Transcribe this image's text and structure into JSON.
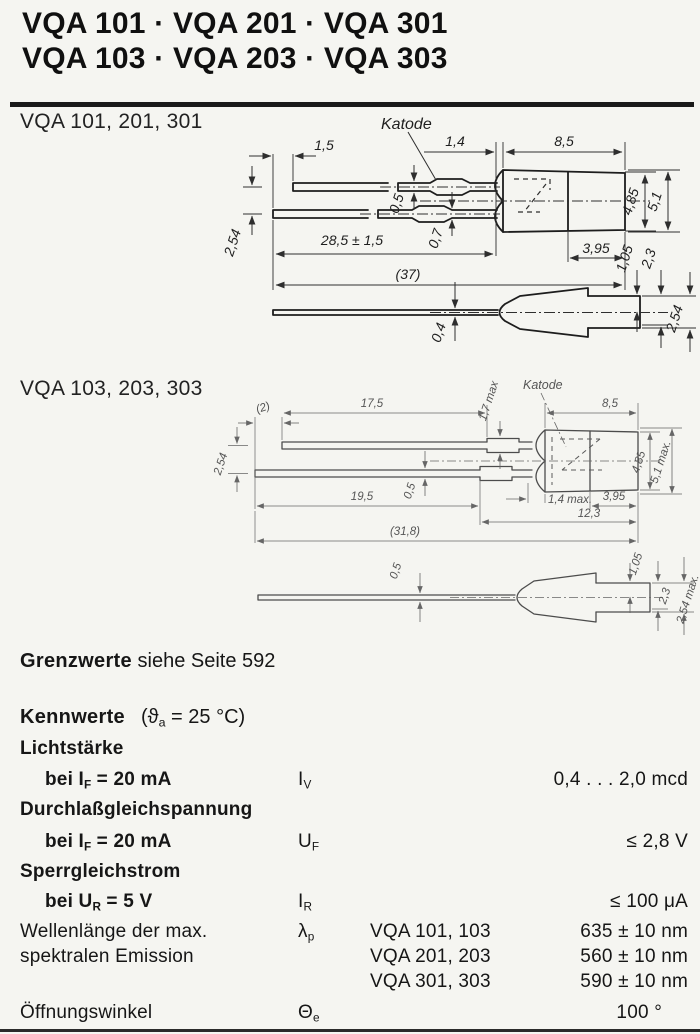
{
  "header": {
    "title_line1": "VQA 101 · VQA 201 · VQA 301",
    "title_line2": "VQA 103 · VQA 203 · VQA 303"
  },
  "drawing1": {
    "label": "VQA 101, 201, 301",
    "katode": "Katode",
    "dims": {
      "lead_stagger": "1,5",
      "flange_width": "1,4",
      "body_length": "8,5",
      "lead_thickness_top": "0,5",
      "lead_thickness_bottom": "0,7",
      "lead_length": "28,5 ± 1,5",
      "total_length": "(37)",
      "lead_pitch": "2,54",
      "front_face": "3,95",
      "body_height_front": "4,85",
      "body_height_max": "5,1",
      "tip_offset": "1,05",
      "tip_height": "2,3",
      "side_lead_thickness": "0,4",
      "side_tip_max": "2,54"
    }
  },
  "drawing2": {
    "label": "VQA 103, 203, 303",
    "katode": "Katode",
    "dims": {
      "lead_stagger": "(2)",
      "lead_length_top": "17,5",
      "crimp_height": "1,7 max",
      "body_length": "8,5",
      "lead_pitch": "2,54",
      "lead_thickness": "0,5",
      "lead_length_bottom": "19,5",
      "flange_width": "1,4 max.",
      "front_face": "3,95",
      "body_inner": "12,3",
      "total_length": "(31,8)",
      "body_height_front": "4,85",
      "body_height_max": "5,1 max.",
      "side_lead_thickness": "0,5",
      "tip_offset": "1,05",
      "tip_height": "2,3",
      "side_tip_max": "2,54 max."
    }
  },
  "grenzwerte": {
    "bold": "Grenzwerte",
    "rest": "siehe Seite 592"
  },
  "kennwerte": {
    "heading": {
      "bold": "Kennwerte",
      "pre": "(ϑ",
      "sub": "a",
      "post": " = 25 °C)"
    },
    "lichtstaerke": {
      "group": "Lichtstärke",
      "cond_pre": "bei I",
      "cond_sub": "F",
      "cond_post": " = 20 mA",
      "sym": "I",
      "sym_sub": "V",
      "value": "0,4 . . . 2,0 mcd"
    },
    "durchlass": {
      "group": "Durchlaßgleichspannung",
      "cond_pre": "bei I",
      "cond_sub": "F",
      "cond_post": " = 20 mA",
      "sym": "U",
      "sym_sub": "F",
      "value": "≤ 2,8 V"
    },
    "sperr": {
      "group": "Sperrgleichstrom",
      "cond_pre": "bei U",
      "cond_sub": "R",
      "cond_post": " = 5 V",
      "sym": "I",
      "sym_sub": "R",
      "value": "≤ 100 μA"
    },
    "wellenlaenge": {
      "label_line1": "Wellenlänge der max.",
      "label_line2": "spektralen Emission",
      "sym": "λ",
      "sym_sub": "p",
      "rows": [
        {
          "name": "VQA 101, 103",
          "value": "635 ± 10 nm"
        },
        {
          "name": "VQA 201, 203",
          "value": "560 ± 10 nm"
        },
        {
          "name": "VQA 301, 303",
          "value": "590 ± 10 nm"
        }
      ]
    },
    "oeffnungswinkel": {
      "label": "Öffnungswinkel",
      "sym": "Θ",
      "sym_sub": "e",
      "value": "100 °"
    }
  }
}
